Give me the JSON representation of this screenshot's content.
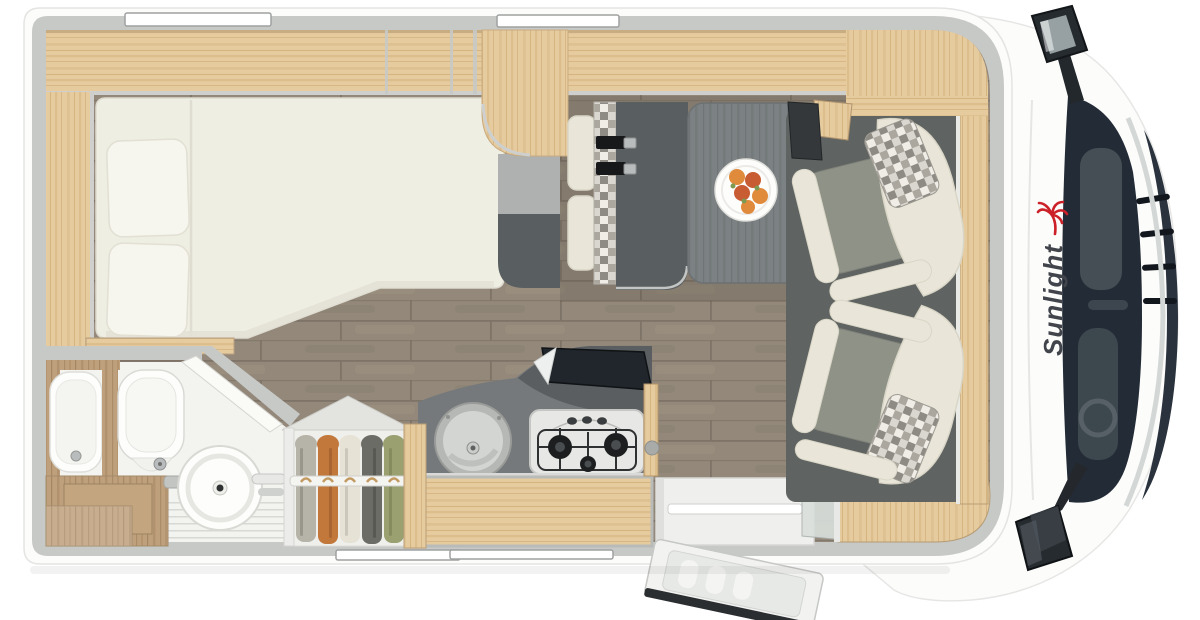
{
  "brand": {
    "logo_text": "Sunlight"
  },
  "floorplan": {
    "view": "top-down",
    "vehicle": "motorhome",
    "visible_items": [
      "double-bed",
      "bed-pillows",
      "overhead-cabinets",
      "window-strips",
      "bathroom-washbasin",
      "toilet",
      "round-swivel-basin",
      "bathroom-vanity",
      "shower-floor",
      "wardrobe-with-hanging-clothes",
      "clothes-rail",
      "kitchen-counter",
      "round-kitchen-sink",
      "gas-stove-3-burner",
      "raised-glass-lid",
      "kitchen-cabinet",
      "entry-step",
      "entry-door-open",
      "side-bench-with-seatbelts",
      "checkered-bench-backrest",
      "dining-table",
      "fruit-plate",
      "swivel-passenger-seat",
      "swivel-driver-seat",
      "checkered-headrest-cushions",
      "cab-floor-mat",
      "tv-panel",
      "rear-sideboard",
      "cab-body",
      "windshield",
      "front-grille",
      "side-mirror-top",
      "side-mirror-bottom",
      "sunlight-logo",
      "palm-icon"
    ]
  },
  "colors": {
    "shell": "#fcfcfb",
    "wall": "#c7c9c7",
    "floorBase": "#93887a",
    "floorSeam": "#7d7366",
    "woodLight": "#e6cb9e",
    "woodGrain": "#d3b27e",
    "woodMid": "#bfa07c",
    "woodMidGrain": "#a3845f",
    "mattress": "#efeee3",
    "pillow": "#f6f5ee",
    "cushion": "#e9e6d9",
    "seatGray": "#8f9287",
    "cabFloor": "#5f6361",
    "tableGray": "#7c8183",
    "tableGrain": "#6e7375",
    "darkSlab": "#595e60",
    "counter": "#75797c",
    "backsplash": "#5a5e60",
    "stoveBody": "#e7e8e5",
    "burner": "#1c1e20",
    "sinkRim": "#b6b8b5",
    "sinkBowl": "#d3d5d2",
    "bathFloor": "#f3f3f0",
    "porcelain": "#fdfdfb",
    "chrome": "#b9bcbd",
    "windshield": "#232b36",
    "cabDark": "#2a323d",
    "mirrorDark": "#262b30",
    "belt": "#17181a",
    "checkA": "#d9d7d0",
    "checkB": "#8e8a84",
    "checkC": "#aba79f",
    "checkD": "#efede6",
    "garment1": "#b6b3a8",
    "garment2": "#c2773b",
    "garment3": "#e6e2d6",
    "garment4": "#6b6c66",
    "garment5": "#9aa070",
    "fruitA": "#e08a3c",
    "fruitB": "#c85c33",
    "leaf": "#7d9a52",
    "windowWhite": "#ffffff",
    "logoText": "#41454b",
    "logoRed": "#cc2128"
  }
}
